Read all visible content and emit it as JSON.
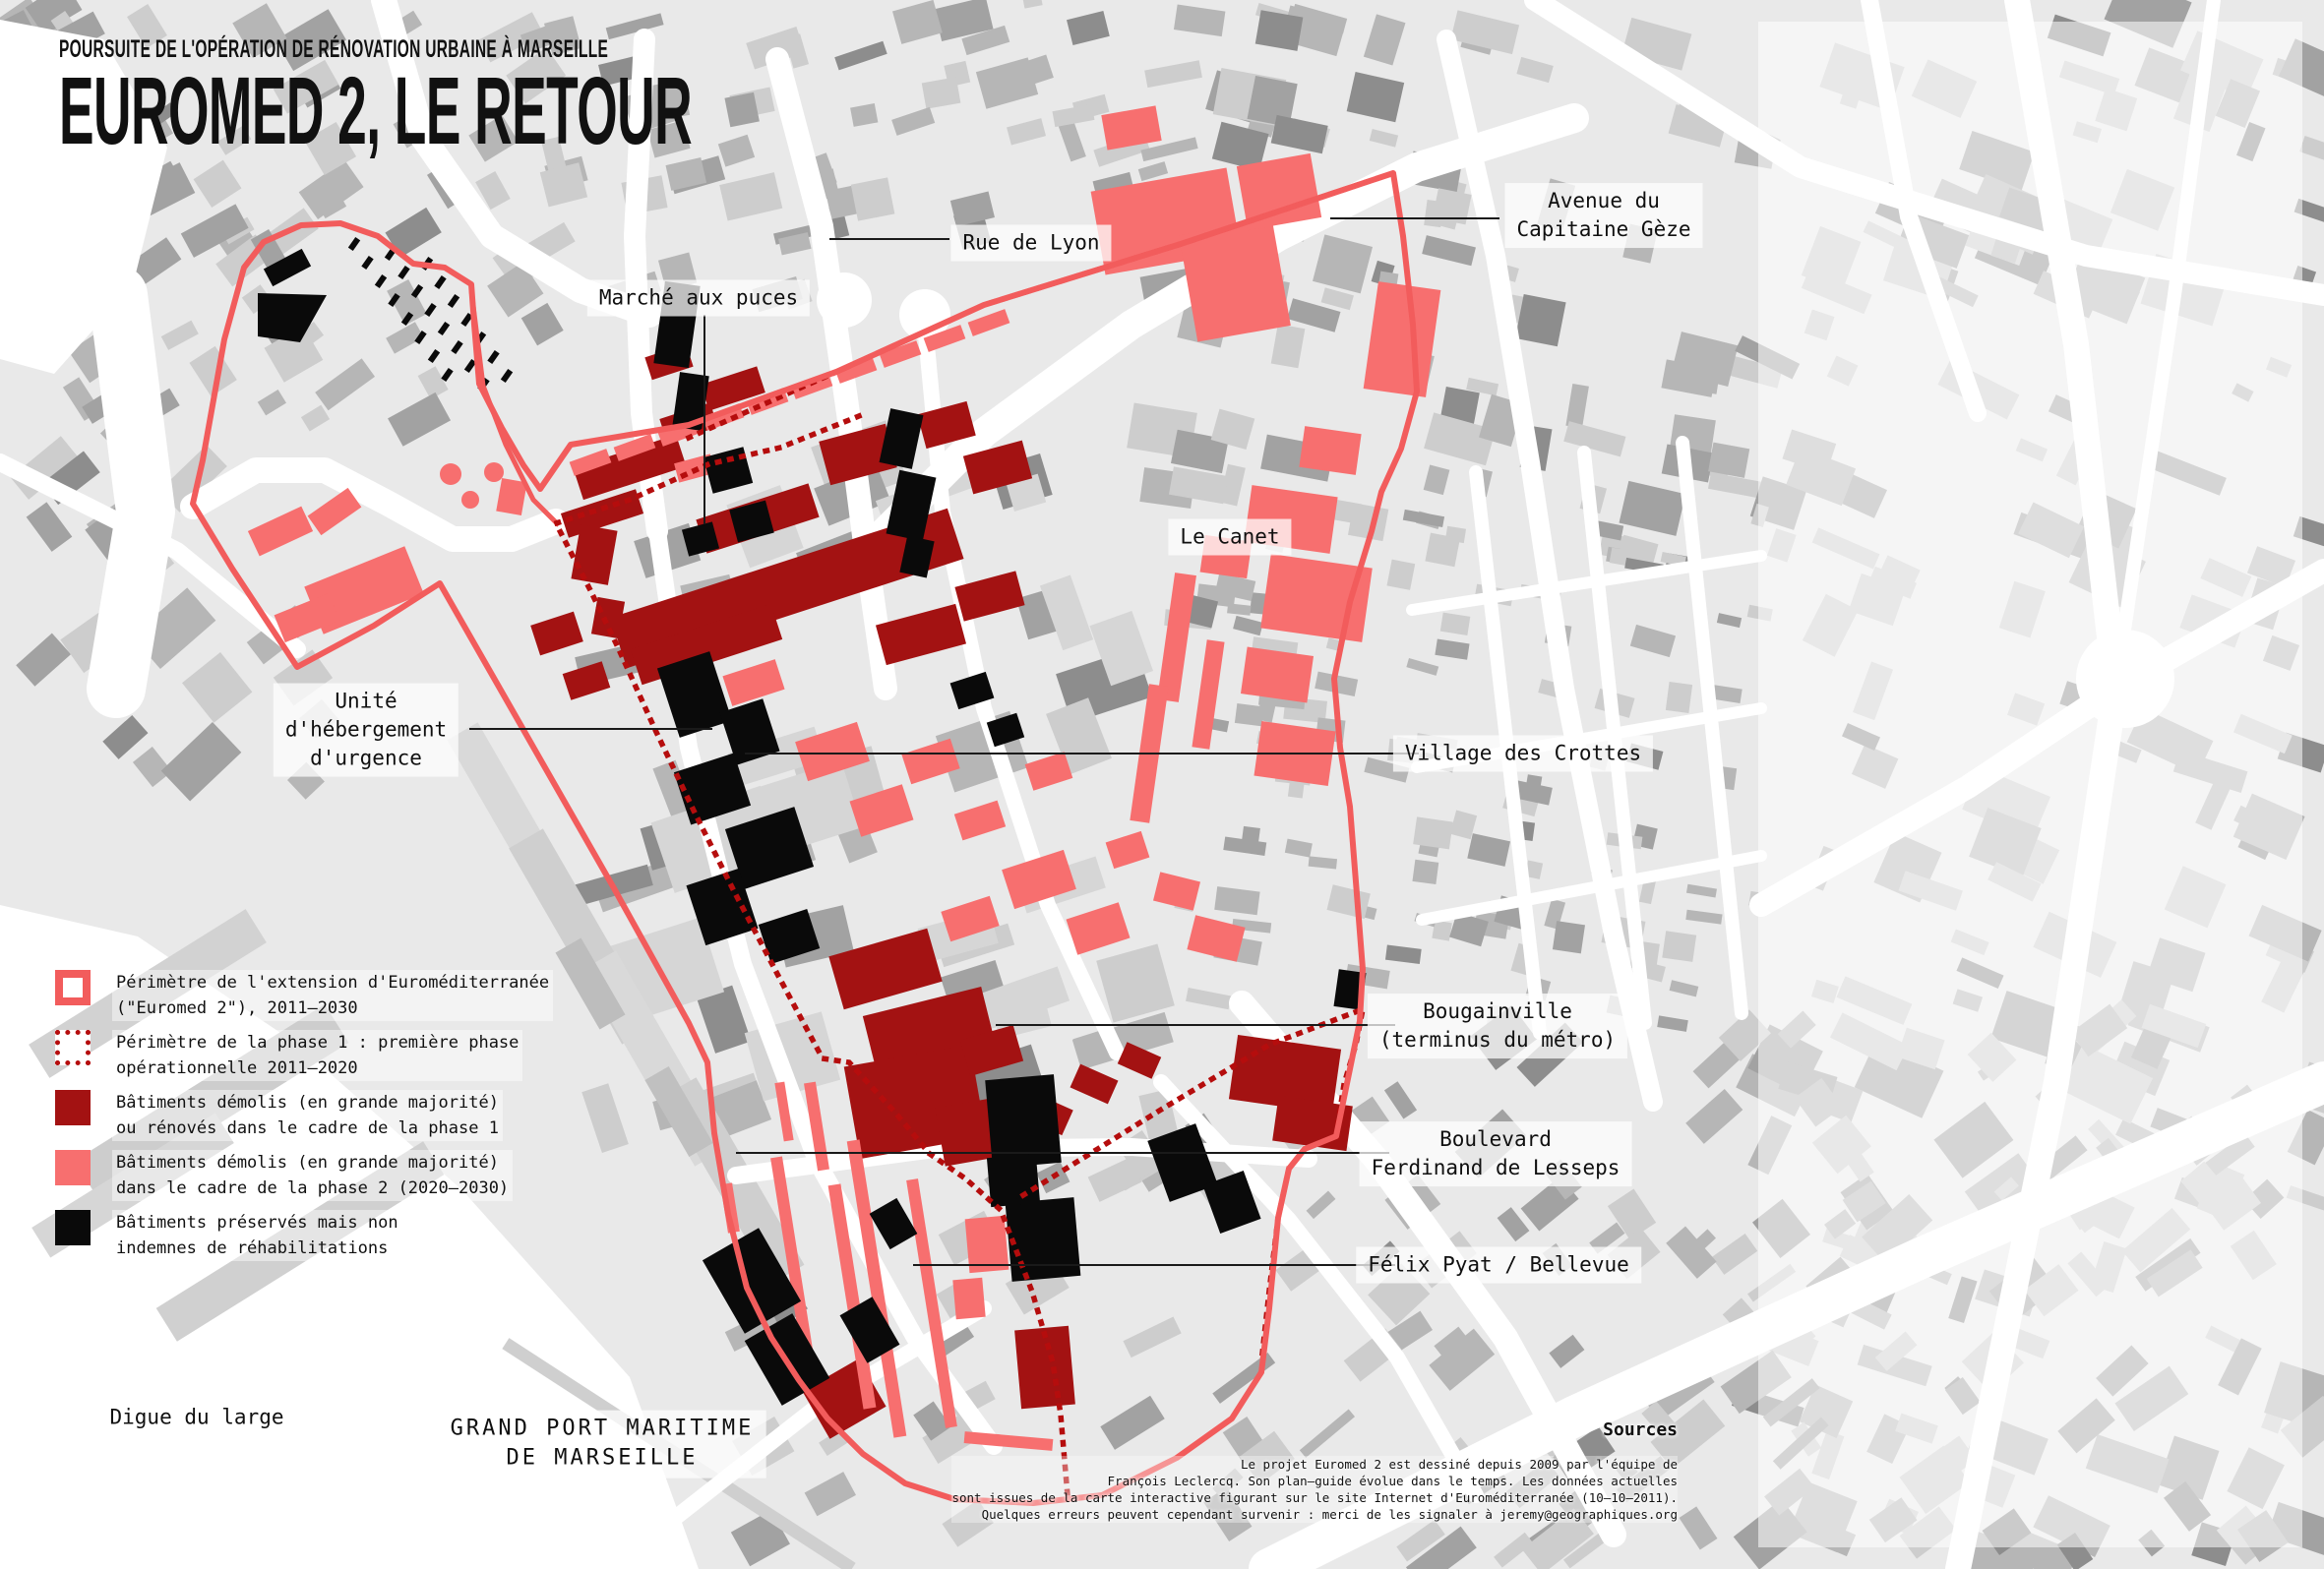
{
  "title": {
    "kicker": "POURSUITE DE L'OPÉRATION DE RÉNOVATION URBAINE À MARSEILLE",
    "main": "EUROMED 2, LE RETOUR"
  },
  "labels": {
    "rue_de_lyon": "Rue de Lyon",
    "avenue_capitaine_geze": "Avenue du\nCapitaine Gèze",
    "marche_aux_puces": "Marché aux puces",
    "le_canet": "Le Canet",
    "unite_hebergement": "Unité\nd'hébergement\nd'urgence",
    "village_des_crottes": "Village des Crottes",
    "bougainville": "Bougainville\n(terminus du métro)",
    "boulevard_lesseps": "Boulevard\nFerdinand de Lesseps",
    "felix_pyat": "Félix Pyat / Bellevue",
    "digue_du_large": "Digue du large",
    "grand_port": "GRAND PORT MARITIME\nDE MARSEILLE"
  },
  "legend": {
    "items": [
      {
        "swatch": "outline_solid",
        "text": "Périmètre de l'extension d'Euroméditerranée\n(\"Euromed 2\"), 2011–2030"
      },
      {
        "swatch": "outline_dotted",
        "text": "Périmètre de la phase 1 : première phase\nopérationnelle 2011–2020"
      },
      {
        "swatch": "fill_phase1",
        "text": "Bâtiments démolis (en grande majorité)\nou rénovés dans le cadre de la phase 1"
      },
      {
        "swatch": "fill_phase2",
        "text": "Bâtiments démolis (en grande majorité)\ndans le cadre de la phase 2 (2020–2030)"
      },
      {
        "swatch": "fill_black",
        "text": "Bâtiments préservés mais non\nindemnes de réhabilitations"
      }
    ]
  },
  "sources": {
    "heading": "Sources",
    "body": "Le projet Euromed 2 est dessiné depuis 2009 par l'équipe de\nFrançois Leclercq. Son plan–guide évolue dans le temps. Les données actuelles\nsont issues de la carte interactive figurant sur le site Internet d'Euroméditerranée (10–10–2011).\nQuelques erreurs peuvent cependant survenir : merci de les signaler à jeremy@geographiques.org"
  },
  "colors": {
    "map_background": "#e9e9e9",
    "perimeter_extension": "#f25c5c",
    "perimeter_phase1": "#b50d0d",
    "buildings_phase1": "#a31212",
    "buildings_phase2": "#f76f6f",
    "buildings_preserved": "#0a0a0a",
    "label_ink": "#111111"
  }
}
